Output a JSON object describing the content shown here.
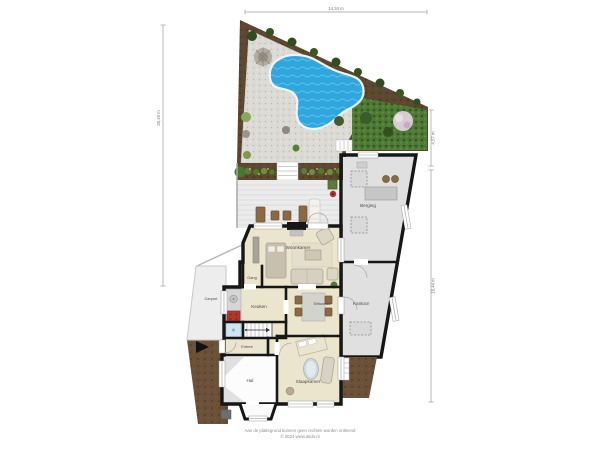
{
  "rooms": {
    "woonkamer": "Woonkamer",
    "keuken": "Keuken",
    "eetkamer": "Eetkamer",
    "slaapkamer": "Slaapkamer",
    "berging": "Berging",
    "kantoor": "Kantoor",
    "gang": "Gang",
    "entree": "Entree",
    "hal": "Hal",
    "carport": "Carport"
  },
  "dimensions": {
    "top": "14,34 m",
    "left": "20,49 m",
    "right_upper": "4,57 m",
    "right_lower": "18,44 m"
  },
  "footer": {
    "disclaimer": "Aan de plattegrond kunnen geen rechten worden ontleend",
    "copyright": "© 2024 www.atido.nl"
  },
  "colors": {
    "wall": "#161616",
    "garden_soil": "#5c4731",
    "gravel": "#dcdad4",
    "pool_water": "#2ea7de",
    "hedge": "#4e7a36",
    "deck": "#ebebeb",
    "storage_floor": "#e0e0e0",
    "house_floor": "#ece5cd",
    "hall_floor": "#fcfcfc",
    "carport_floor": "#ededed",
    "earth_patch": "#6a5138"
  }
}
